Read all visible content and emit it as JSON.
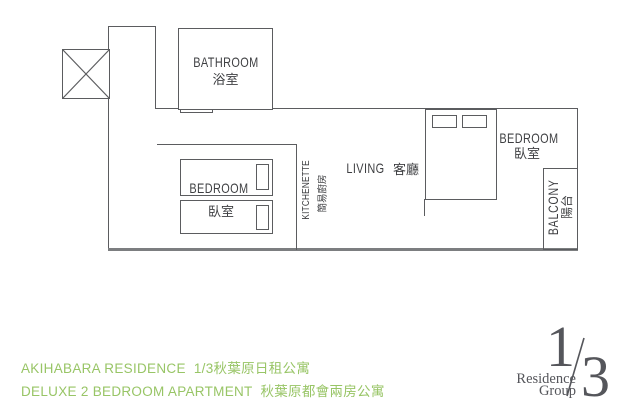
{
  "plan": {
    "bathroom": {
      "en": "BATHROOM",
      "zh": "浴室"
    },
    "bedroom_small": {
      "en": "BEDROOM",
      "zh": "臥室"
    },
    "kitchenette": {
      "en": "KITCHENETTE",
      "zh": "簡易廚房"
    },
    "living": {
      "en": "LIVING",
      "zh": "客廳"
    },
    "bedroom_master": {
      "en": "BEDROOM",
      "zh": "臥室"
    },
    "balcony": {
      "en": "BALCONY",
      "zh": "陽台"
    }
  },
  "footer": {
    "line1": "AKIHABARA RESIDENCE  1/3秋葉原日租公寓",
    "line2": "DELUXE 2 BEDROOM APARTMENT  秋葉原都會兩房公寓"
  },
  "logo": {
    "numerator": "1",
    "denominator": "3",
    "name_top": "Residence",
    "name_bottom": "Group"
  },
  "colors": {
    "accent_green": "#98c566",
    "plan_line": "#5b5c5f",
    "plan_text": "#3e3f42",
    "logo_gray": "#55565b"
  }
}
